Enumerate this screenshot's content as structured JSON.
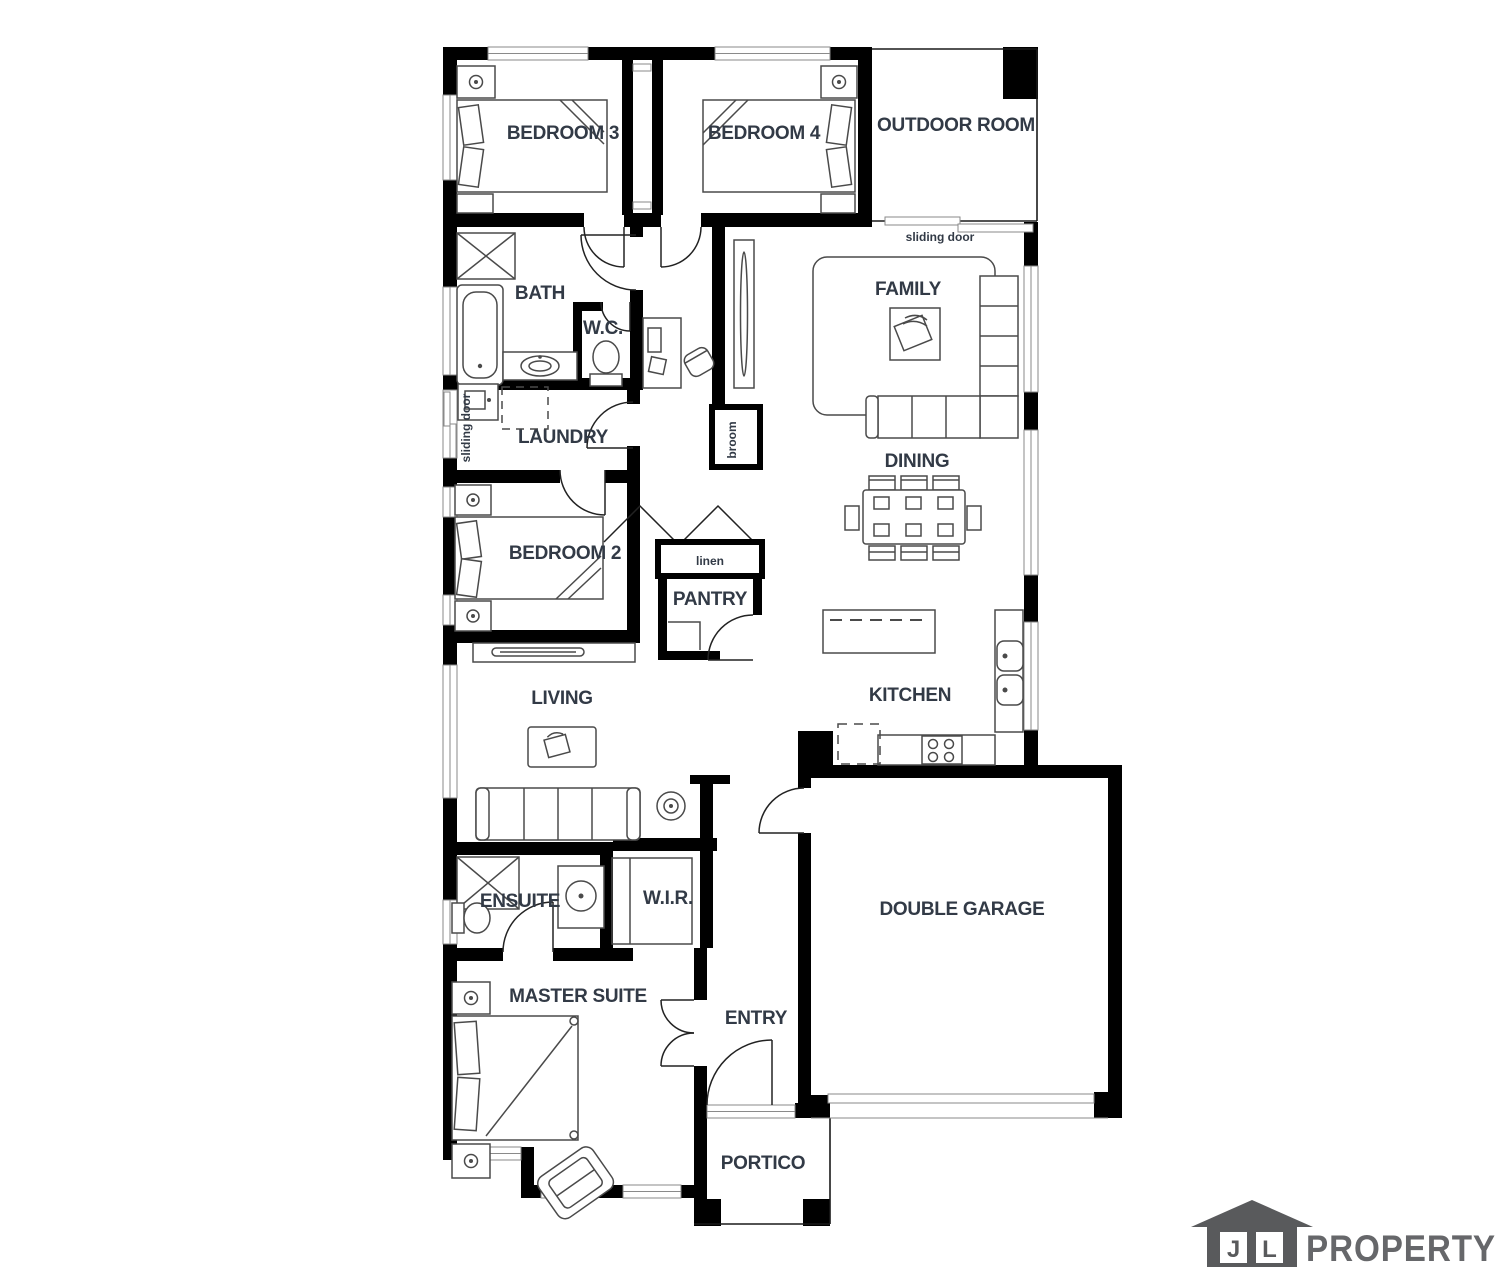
{
  "plan": {
    "rooms": {
      "bedroom3": "BEDROOM 3",
      "bedroom4": "BEDROOM 4",
      "outdoor_room": "OUTDOOR ROOM",
      "bath": "BATH",
      "wc": "W.C.",
      "family": "FAMILY",
      "laundry": "LAUNDRY",
      "dining": "DINING",
      "bedroom2": "BEDROOM 2",
      "pantry": "PANTRY",
      "living": "LIVING",
      "kitchen": "KITCHEN",
      "ensuite": "ENSUITE",
      "wir": "W.I.R.",
      "double_garage": "DOUBLE GARAGE",
      "master_suite": "MASTER SUITE",
      "entry": "ENTRY",
      "portico": "PORTICO"
    },
    "annotations": {
      "sliding_door_top": "sliding door",
      "sliding_door_left": "sliding door",
      "broom": "broom",
      "linen": "linen"
    },
    "colors": {
      "wall": "#000000",
      "label": "#323a46",
      "furniture": "#4a4a4a",
      "logo_gray": "#595a5c"
    }
  },
  "logo": {
    "j": "J",
    "l": "L",
    "name": "PROPERTY"
  }
}
